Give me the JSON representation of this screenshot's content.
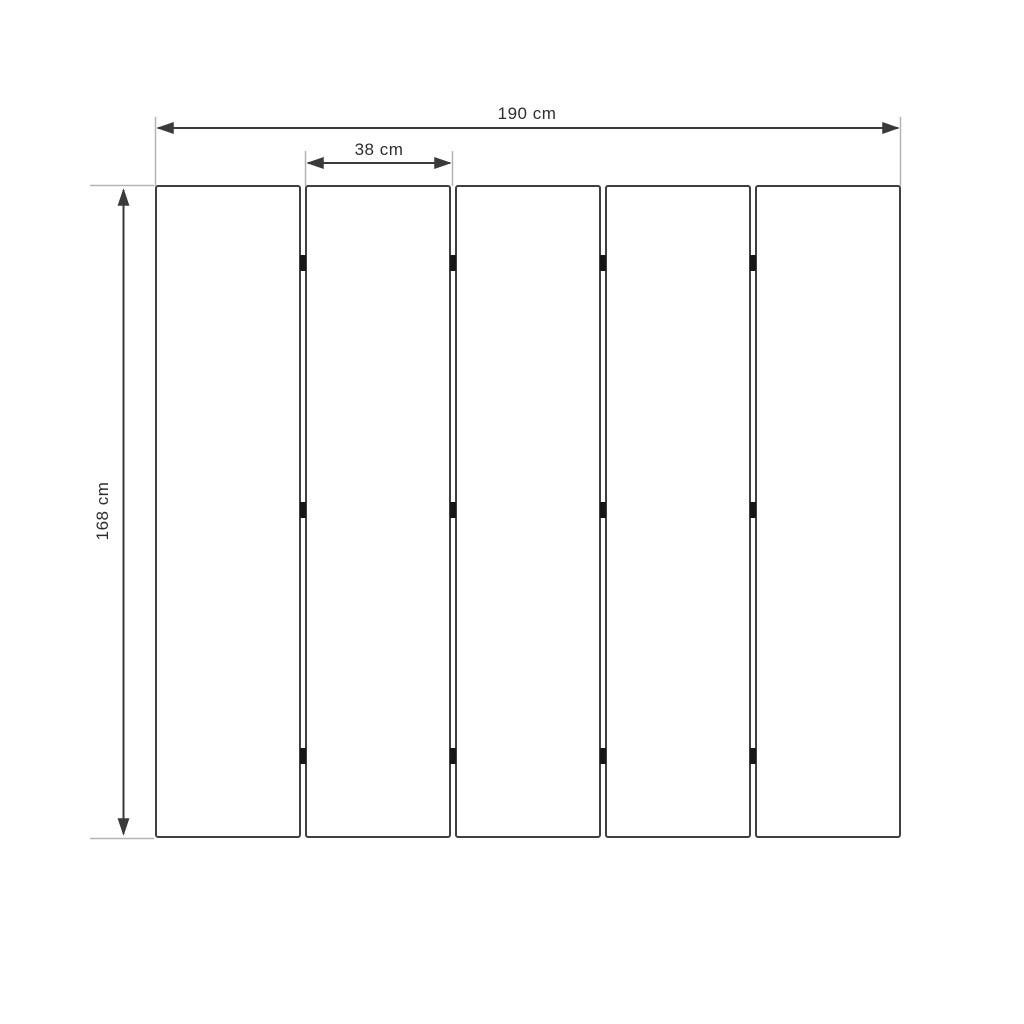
{
  "diagram": {
    "type": "panel-dimension-drawing",
    "panel_count": 5,
    "hinge_rows": 3,
    "dimensions": {
      "total_width_label": "190 cm",
      "panel_width_label": "38 cm",
      "height_label": "168 cm"
    },
    "colors": {
      "background": "#ffffff",
      "panel_border": "#3f3f3f",
      "dimension_line": "#3a3a3a",
      "extension_line": "#b5b5b5",
      "hinge": "#161616",
      "text": "#2e2e2e"
    }
  }
}
